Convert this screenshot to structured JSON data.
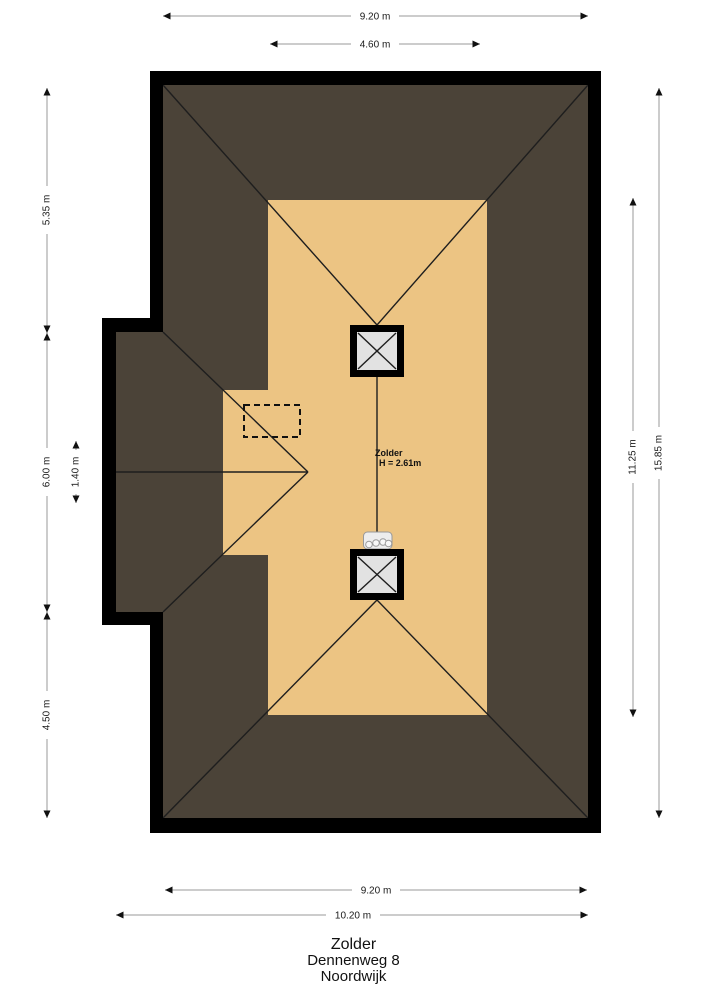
{
  "room": {
    "name": "Zolder",
    "height": "H = 2.61m"
  },
  "dimensions": {
    "top_width": "9.20 m",
    "top_inner": "4.60 m",
    "left_upper": "5.35 m",
    "left_middle": "6.00 m",
    "left_lower": "4.50 m",
    "left_inner": "1.40 m",
    "right_floor": "11.25 m",
    "right_total": "15.85 m",
    "bottom_width": "9.20 m",
    "bottom_total": "10.20 m"
  },
  "title_block": {
    "line1": "Zolder",
    "line2": "Dennenweg 8",
    "line3": "Noordwijk"
  },
  "colors": {
    "background": "#ffffff",
    "wall": "#000000",
    "roof": "#4b4338",
    "floor": "#ecc483",
    "chimney_fill": "#e2e2e2",
    "roof_line": "#1e1e1e",
    "dimension_line": "#9a9a9a",
    "dimension_text": "#1a1a1a"
  }
}
